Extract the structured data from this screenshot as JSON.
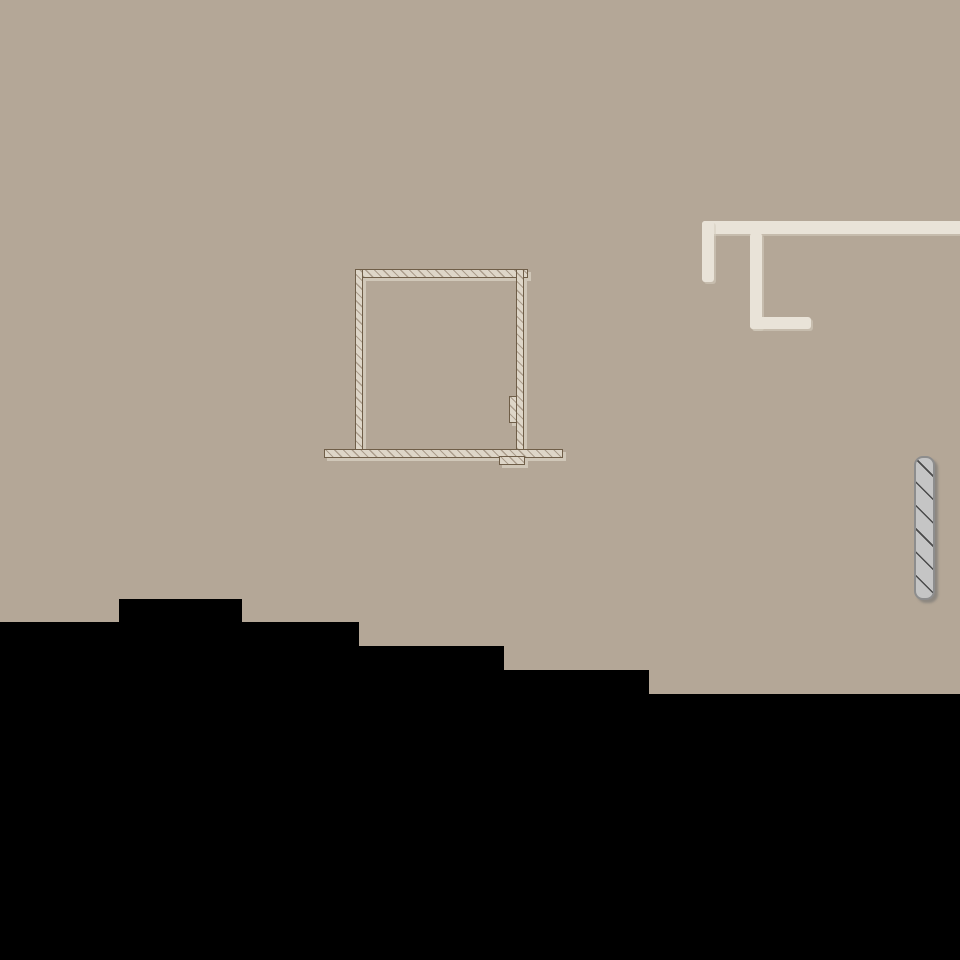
{
  "canvas": {
    "description": "plain drawing canvas, no visible text or UI chrome",
    "width": 960,
    "height": 960
  },
  "colors": {
    "bg": "#b4a797",
    "path": "#e9e3d8",
    "wall-fill": "#ded6c8",
    "wall-hatch": "#ab9d8c",
    "wall-line": "#6f5e48",
    "room-shadow": "#d0c7b8",
    "ins-fill": "#c5c5c5",
    "ins-border": "#8d8d8d",
    "ins-hatch": "#4a4a4a",
    "terrain": "#000000"
  },
  "wall_path": {
    "top_bar": [
      702,
      221,
      258,
      13
    ],
    "left_stub": [
      702,
      221,
      12,
      61
    ],
    "mid_stub": [
      750,
      233,
      12,
      96
    ],
    "bottom_bar": [
      750,
      317,
      61,
      12
    ]
  },
  "room": {
    "top_wall": [
      355,
      269,
      173,
      9
    ],
    "left_wall": [
      355,
      269,
      8,
      181
    ],
    "right_wall": [
      516,
      269,
      8,
      188
    ],
    "door_jamb": [
      509,
      396,
      8,
      27
    ],
    "floor_slab": [
      324,
      449,
      239,
      9
    ],
    "footing": [
      499,
      456,
      26,
      9
    ]
  },
  "insulation": {
    "rect": [
      914,
      456,
      21,
      144
    ]
  },
  "terrain": {
    "points": "0,622 119,622 119,599 242,599 242,622 359,622 359,646 504,646 504,670 649,670 649,694 960,694 960,960 0,960"
  }
}
